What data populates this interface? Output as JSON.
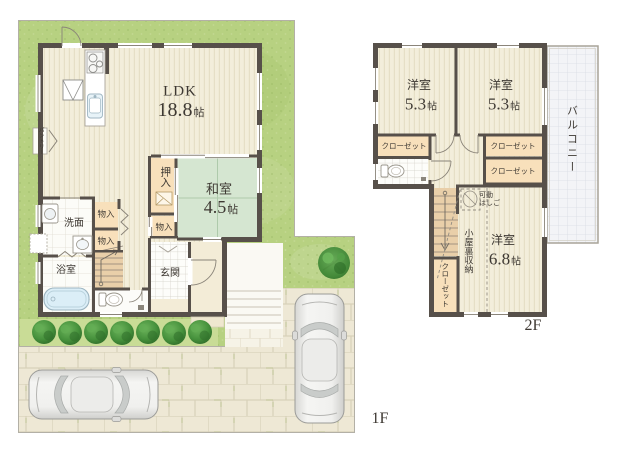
{
  "floorplan": {
    "floor1": {
      "floor_label": "1F",
      "rooms": {
        "ldk": {
          "name": "LDK",
          "size_value": "18.8",
          "size_unit": "帖"
        },
        "washitsu": {
          "name": "和室",
          "size_value": "4.5",
          "size_unit": "帖"
        },
        "oshiire": {
          "name": "押入"
        },
        "monoire_1": {
          "name": "物入"
        },
        "monoire_2": {
          "name": "物入"
        },
        "monoire_3": {
          "name": "物入"
        },
        "senmen": {
          "name": "洗面"
        },
        "yokushitsu": {
          "name": "浴室"
        },
        "genkan": {
          "name": "玄関"
        },
        "pantry": {
          "name": "パントリー"
        }
      }
    },
    "floor2": {
      "floor_label": "2F",
      "rooms": {
        "yoshitsu_left": {
          "name": "洋室",
          "size_value": "5.3",
          "size_unit": "帖"
        },
        "yoshitsu_right": {
          "name": "洋室",
          "size_value": "5.3",
          "size_unit": "帖"
        },
        "yoshitsu_large": {
          "name": "洋室",
          "size_value": "6.8",
          "size_unit": "帖"
        },
        "closet_left": {
          "name": "クローゼット"
        },
        "closet_right_upper": {
          "name": "クローゼット"
        },
        "closet_right_lower": {
          "name": "クローゼット"
        },
        "closet_bottom": {
          "name": "クローゼット"
        },
        "attic_storage": {
          "name": "小屋裏収納"
        },
        "ladder": {
          "line1": "可動",
          "line2": "はしご"
        },
        "balcony": {
          "name": "バルコニー"
        }
      }
    },
    "colors": {
      "wall": "#57504a",
      "wood_floor": "#f3eedb",
      "tatami": "#d5e6d1",
      "closet": "#f8e0bb",
      "stairs": "#e9cfa9",
      "lawn": "#b7d181",
      "hedge": "#3f8738",
      "pavement": "#eee8d5",
      "tile": "#fdfdfa",
      "water": "#dbeef7",
      "text": "#3e3933"
    }
  }
}
